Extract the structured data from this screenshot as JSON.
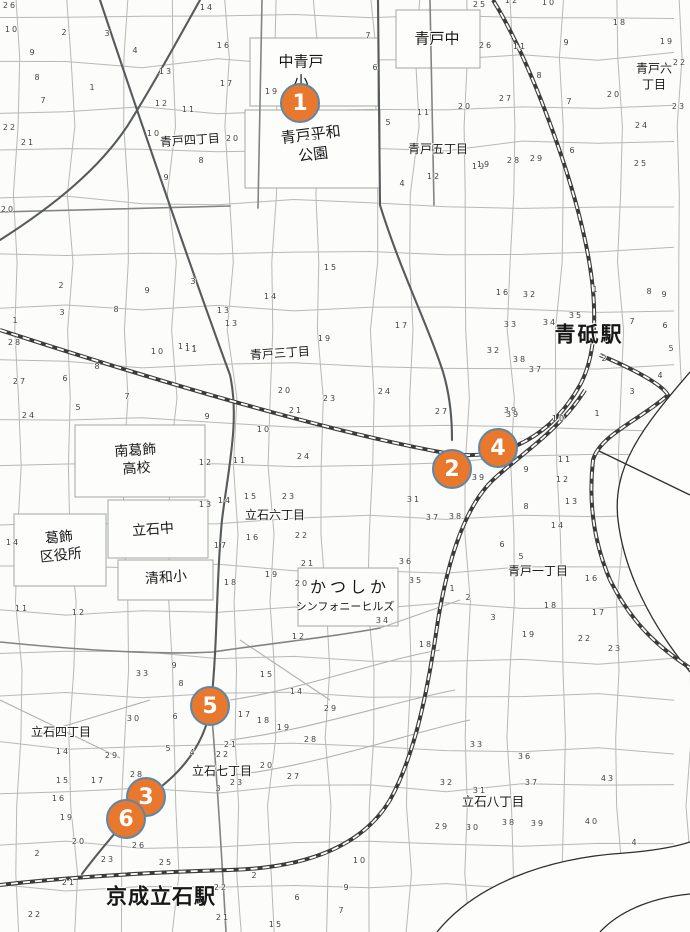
{
  "map": {
    "width": 690,
    "height": 932,
    "background": "#fcfcfa",
    "marker_style": {
      "fill": "#E8782D",
      "border": "#5D87A8",
      "text": "#FFFFFF"
    }
  },
  "markers": [
    {
      "id": "marker-1",
      "num": "1",
      "x": 300,
      "y": 103
    },
    {
      "id": "marker-4",
      "num": "4",
      "x": 498,
      "y": 448
    },
    {
      "id": "marker-2",
      "num": "2",
      "x": 452,
      "y": 469
    },
    {
      "id": "marker-5",
      "num": "5",
      "x": 210,
      "y": 706
    },
    {
      "id": "marker-3",
      "num": "3",
      "x": 146,
      "y": 797
    },
    {
      "id": "marker-6",
      "num": "6",
      "x": 126,
      "y": 819
    }
  ],
  "labels": [
    {
      "name": "naka-aoto-elementary",
      "text": "中青戸\n小",
      "x": 301,
      "y": 72,
      "size": 15
    },
    {
      "name": "aoto-junior-high",
      "text": "青戸中",
      "x": 437,
      "y": 39,
      "size": 15
    },
    {
      "name": "aoto-6-chome",
      "text": "青戸六丁目",
      "x": 654,
      "y": 77,
      "size": 12
    },
    {
      "name": "aoto-heiwa-park",
      "text": "青戸平和\n公園",
      "x": 312,
      "y": 145,
      "size": 15,
      "rotate": -7
    },
    {
      "name": "aoto-4-chome",
      "text": "青戸四丁目",
      "x": 190,
      "y": 141,
      "size": 12,
      "rotate": -4
    },
    {
      "name": "aoto-5-chome",
      "text": "青戸五丁目",
      "x": 438,
      "y": 150,
      "size": 12
    },
    {
      "name": "aoto-3-chome",
      "text": "青戸三丁目",
      "x": 280,
      "y": 354,
      "size": 12,
      "rotate": -4
    },
    {
      "name": "aoto-station",
      "text": "青砥駅",
      "x": 589,
      "y": 335,
      "size": 21,
      "bold": true,
      "spacing": 2
    },
    {
      "name": "minami-katsushika-high-school",
      "text": "南葛飾\n高校",
      "x": 136,
      "y": 460,
      "size": 14,
      "rotate": -4
    },
    {
      "name": "katsushika-ward-office",
      "text": "葛飾\n区役所",
      "x": 60,
      "y": 547,
      "size": 14,
      "rotate": -6
    },
    {
      "name": "tateishi-junior-high",
      "text": "立石中",
      "x": 153,
      "y": 530,
      "size": 14,
      "rotate": -4
    },
    {
      "name": "seiwa-elementary",
      "text": "清和小",
      "x": 166,
      "y": 578,
      "size": 14,
      "rotate": -4
    },
    {
      "name": "tateishi-6-chome",
      "text": "立石六丁目",
      "x": 275,
      "y": 516,
      "size": 12
    },
    {
      "name": "aoto-1-chome",
      "text": "青戸一丁目",
      "x": 538,
      "y": 572,
      "size": 12
    },
    {
      "name": "katsushika-symphony-hills",
      "text": "かつしか",
      "x": 350,
      "y": 588,
      "size": 16,
      "spacing": 4
    },
    {
      "name": "katsushika-symphony-hills-sub",
      "text": "シンフォニーヒルズ",
      "x": 345,
      "y": 607,
      "size": 11
    },
    {
      "name": "tateishi-4-chome",
      "text": "立石四丁目",
      "x": 61,
      "y": 733,
      "size": 12
    },
    {
      "name": "tateishi-7-chome",
      "text": "立石七丁目",
      "x": 222,
      "y": 772,
      "size": 12
    },
    {
      "name": "tateishi-8-chome",
      "text": "立石八丁目",
      "x": 493,
      "y": 802,
      "size": 12.5
    },
    {
      "name": "keisei-tateishi-station",
      "text": "京成立石駅",
      "x": 161,
      "y": 897,
      "size": 21,
      "bold": true,
      "spacing": 1
    }
  ],
  "parcel_numbers": [
    [
      "26",
      10,
      6
    ],
    [
      "10",
      12,
      30
    ],
    [
      "2",
      65,
      33
    ],
    [
      "3",
      108,
      34
    ],
    [
      "14",
      207,
      8
    ],
    [
      "9",
      33,
      53
    ],
    [
      "4",
      136,
      51
    ],
    [
      "16",
      224,
      46
    ],
    [
      "8",
      38,
      78
    ],
    [
      "13",
      166,
      72
    ],
    [
      "17",
      227,
      84
    ],
    [
      "7",
      44,
      101
    ],
    [
      "1",
      93,
      88
    ],
    [
      "12",
      162,
      104
    ],
    [
      "11",
      189,
      110
    ],
    [
      "22",
      10,
      128
    ],
    [
      "21",
      28,
      143
    ],
    [
      "10",
      154,
      134
    ],
    [
      "8",
      202,
      161
    ],
    [
      "9",
      167,
      178
    ],
    [
      "20",
      8,
      210
    ],
    [
      "7",
      369,
      36
    ],
    [
      "6",
      376,
      68
    ],
    [
      "19",
      272,
      92
    ],
    [
      "5",
      389,
      123
    ],
    [
      "11",
      424,
      113
    ],
    [
      "23",
      312,
      138
    ],
    [
      "20",
      233,
      139
    ],
    [
      "12",
      434,
      177
    ],
    [
      "4",
      403,
      184
    ],
    [
      "19",
      479,
      167
    ],
    [
      "28",
      514,
      161
    ],
    [
      "29",
      537,
      159
    ],
    [
      "6",
      573,
      151
    ],
    [
      "25",
      480,
      5
    ],
    [
      "12",
      512,
      1
    ],
    [
      "10",
      549,
      3
    ],
    [
      "18",
      620,
      23
    ],
    [
      "19",
      667,
      42
    ],
    [
      "26",
      486,
      46
    ],
    [
      "11",
      520,
      47
    ],
    [
      "9",
      567,
      43
    ],
    [
      "22",
      680,
      63
    ],
    [
      "8",
      540,
      76
    ],
    [
      "27",
      506,
      99
    ],
    [
      "7",
      570,
      102
    ],
    [
      "20",
      465,
      107
    ],
    [
      "20",
      614,
      95
    ],
    [
      "23",
      679,
      107
    ],
    [
      "24",
      642,
      126
    ],
    [
      "19",
      484,
      165
    ],
    [
      "25",
      641,
      164
    ],
    [
      "15",
      331,
      268
    ],
    [
      "3",
      194,
      282
    ],
    [
      "14",
      271,
      297
    ],
    [
      "13",
      224,
      311
    ],
    [
      "11",
      185,
      347
    ],
    [
      "2",
      62,
      286
    ],
    [
      "3",
      63,
      313
    ],
    [
      "8",
      117,
      310
    ],
    [
      "9",
      148,
      291
    ],
    [
      "1",
      16,
      321
    ],
    [
      "28",
      15,
      343
    ],
    [
      "27",
      20,
      382
    ],
    [
      "10",
      158,
      352
    ],
    [
      "11",
      192,
      349
    ],
    [
      "6",
      66,
      379
    ],
    [
      "7",
      128,
      397
    ],
    [
      "5",
      79,
      408
    ],
    [
      "24",
      29,
      416
    ],
    [
      "8",
      98,
      367
    ],
    [
      "16",
      503,
      293
    ],
    [
      "32",
      530,
      295
    ],
    [
      "33",
      511,
      325
    ],
    [
      "34",
      550,
      323
    ],
    [
      "35",
      576,
      316
    ],
    [
      "1",
      596,
      290
    ],
    [
      "8",
      650,
      292
    ],
    [
      "9",
      665,
      295
    ],
    [
      "7",
      633,
      322
    ],
    [
      "6",
      666,
      326
    ],
    [
      "5",
      672,
      349
    ],
    [
      "2",
      605,
      359
    ],
    [
      "4",
      661,
      376
    ],
    [
      "3",
      633,
      392
    ],
    [
      "32",
      494,
      351
    ],
    [
      "38",
      520,
      360
    ],
    [
      "37",
      536,
      370
    ],
    [
      "39",
      511,
      411
    ],
    [
      "13",
      232,
      324
    ],
    [
      "19",
      325,
      339
    ],
    [
      "17",
      402,
      326
    ],
    [
      "1",
      195,
      350
    ],
    [
      "20",
      285,
      391
    ],
    [
      "23",
      330,
      399
    ],
    [
      "24",
      385,
      392
    ],
    [
      "21",
      296,
      411
    ],
    [
      "9",
      208,
      417
    ],
    [
      "27",
      442,
      412
    ],
    [
      "39",
      513,
      415
    ],
    [
      "10",
      559,
      419
    ],
    [
      "11",
      565,
      460
    ],
    [
      "9",
      527,
      470
    ],
    [
      "12",
      563,
      480
    ],
    [
      "13",
      572,
      502
    ],
    [
      "8",
      527,
      507
    ],
    [
      "31",
      414,
      500
    ],
    [
      "37",
      433,
      518
    ],
    [
      "38",
      456,
      517
    ],
    [
      "39",
      479,
      478
    ],
    [
      "1",
      598,
      414
    ],
    [
      "10",
      264,
      430
    ],
    [
      "24",
      304,
      457
    ],
    [
      "12",
      206,
      463
    ],
    [
      "11",
      240,
      461
    ],
    [
      "23",
      289,
      497
    ],
    [
      "15",
      251,
      497
    ],
    [
      "14",
      225,
      501
    ],
    [
      "13",
      206,
      505
    ],
    [
      "22",
      302,
      536
    ],
    [
      "16",
      253,
      538
    ],
    [
      "17",
      221,
      546
    ],
    [
      "19",
      272,
      575
    ],
    [
      "18",
      231,
      583
    ],
    [
      "20",
      302,
      584
    ],
    [
      "14",
      13,
      543
    ],
    [
      "11",
      22,
      609
    ],
    [
      "12",
      79,
      613
    ],
    [
      "21",
      308,
      564
    ],
    [
      "36",
      406,
      562
    ],
    [
      "35",
      416,
      581
    ],
    [
      "34",
      383,
      621
    ],
    [
      "1",
      453,
      589
    ],
    [
      "2",
      469,
      598
    ],
    [
      "12",
      299,
      637
    ],
    [
      "18",
      426,
      645
    ],
    [
      "16",
      592,
      579
    ],
    [
      "17",
      599,
      613
    ],
    [
      "22",
      585,
      639
    ],
    [
      "23",
      615,
      649
    ],
    [
      "14",
      558,
      526
    ],
    [
      "6",
      503,
      545
    ],
    [
      "5",
      522,
      557
    ],
    [
      "18",
      551,
      606
    ],
    [
      "3",
      494,
      618
    ],
    [
      "19",
      529,
      635
    ],
    [
      "9",
      175,
      666
    ],
    [
      "33",
      143,
      674
    ],
    [
      "8",
      182,
      684
    ],
    [
      "15",
      267,
      675
    ],
    [
      "14",
      297,
      692
    ],
    [
      "29",
      331,
      709
    ],
    [
      "30",
      134,
      719
    ],
    [
      "6",
      176,
      717
    ],
    [
      "17",
      245,
      715
    ],
    [
      "18",
      264,
      721
    ],
    [
      "19",
      284,
      728
    ],
    [
      "28",
      311,
      740
    ],
    [
      "5",
      169,
      749
    ],
    [
      "4",
      193,
      753
    ],
    [
      "21",
      231,
      745
    ],
    [
      "22",
      223,
      755
    ],
    [
      "20",
      267,
      766
    ],
    [
      "27",
      294,
      777
    ],
    [
      "23",
      237,
      783
    ],
    [
      "3",
      219,
      789
    ],
    [
      "14",
      63,
      752
    ],
    [
      "29",
      112,
      756
    ],
    [
      "15",
      63,
      781
    ],
    [
      "17",
      98,
      781
    ],
    [
      "16",
      59,
      799
    ],
    [
      "28",
      137,
      775
    ],
    [
      "19",
      67,
      818
    ],
    [
      "20",
      79,
      842
    ],
    [
      "2",
      38,
      854
    ],
    [
      "23",
      108,
      860
    ],
    [
      "26",
      139,
      846
    ],
    [
      "25",
      166,
      863
    ],
    [
      "21",
      69,
      883
    ],
    [
      "22",
      35,
      915
    ],
    [
      "33",
      477,
      745
    ],
    [
      "36",
      525,
      757
    ],
    [
      "37",
      532,
      783
    ],
    [
      "43",
      608,
      779
    ],
    [
      "32",
      447,
      783
    ],
    [
      "31",
      480,
      791
    ],
    [
      "38",
      509,
      823
    ],
    [
      "39",
      538,
      824
    ],
    [
      "40",
      592,
      822
    ],
    [
      "29",
      442,
      827
    ],
    [
      "30",
      473,
      828
    ],
    [
      "4",
      635,
      843
    ],
    [
      "21",
      223,
      918
    ],
    [
      "22",
      221,
      888
    ],
    [
      "2",
      255,
      876
    ],
    [
      "6",
      298,
      898
    ],
    [
      "10",
      360,
      861
    ],
    [
      "9",
      347,
      888
    ],
    [
      "7",
      342,
      911
    ],
    [
      "15",
      276,
      925
    ]
  ]
}
